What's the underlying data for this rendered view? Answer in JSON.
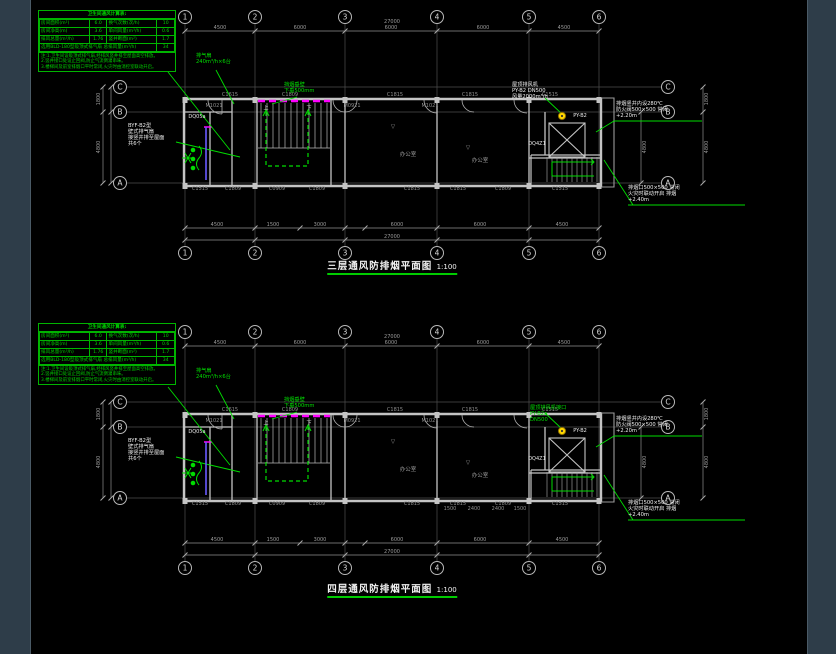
{
  "colors": {
    "canvas": "#000000",
    "margin": "#2e3d49",
    "green": "#00dd00",
    "magenta": "#ff00ff",
    "yellow": "#ffd700",
    "wall": "#c4c4c4",
    "dim_text": "#9a9a9a"
  },
  "legend": {
    "title": "卫生间通风计算表:",
    "rows": [
      [
        "房间面积(m²)",
        "6.0",
        "换气次数(次/h)",
        "10"
      ],
      [
        "房间净高(m)",
        "3.6",
        "单间风量(m³/h)",
        "0.6"
      ],
      [
        "排风总量(m³/h)",
        "1.76",
        "竖井断面(m²)",
        "1.7"
      ]
    ],
    "merged_label": "选用BLD-180型吸顶式排气扇 总排风量(m³/h)",
    "merged_value": "34",
    "notes": [
      "注:1.卫生间设吸顶式排气扇,经排风竖井排至屋面高空排放。",
      "2.竖井接口处设止回阀,防止气流倒灌串味。",
      "3.楼梯间及前室排烟口平时常闭,火灾时由消控室联动开启。"
    ]
  },
  "plans": [
    {
      "title": "三层通风防排烟平面图",
      "scale": "1:100",
      "title_y": 258,
      "offset_y": 0,
      "grid": {
        "cols": [
          "1",
          "2",
          "3",
          "4",
          "5",
          "6"
        ],
        "rows": [
          "C",
          "B",
          "A"
        ]
      },
      "dims": {
        "top_overall": "27000",
        "top_segments": [
          {
            "t": "4500",
            "x": 220
          },
          {
            "t": "6000",
            "x": 300
          },
          {
            "t": "6000",
            "x": 391
          },
          {
            "t": "6000",
            "x": 483
          },
          {
            "t": "4500",
            "x": 564
          }
        ],
        "bottom_segments": [
          {
            "t": "4500",
            "x": 217
          },
          {
            "t": "1500",
            "x": 273
          },
          {
            "t": "3000",
            "x": 320
          },
          {
            "t": "6000",
            "x": 397
          },
          {
            "t": "6000",
            "x": 480
          },
          {
            "t": "4500",
            "x": 562
          }
        ],
        "bottom_overall": "27000",
        "left": [
          {
            "t": "1800",
            "y": 99
          },
          {
            "t": "4800",
            "y": 147
          }
        ],
        "right": [
          {
            "t": "1800",
            "y": 99
          },
          {
            "t": "4800",
            "y": 147
          }
        ],
        "right_inner": [
          {
            "t": "4800",
            "y": 147
          }
        ]
      },
      "tags": [
        {
          "t": "C1615",
          "x": 230,
          "y": 95,
          "c": "g"
        },
        {
          "t": "C1809",
          "x": 290,
          "y": 95,
          "c": "g"
        },
        {
          "t": "C1815",
          "x": 395,
          "y": 95,
          "c": "g"
        },
        {
          "t": "C1815",
          "x": 470,
          "y": 95,
          "c": "g"
        },
        {
          "t": "C1515",
          "x": 550,
          "y": 95,
          "c": "g"
        },
        {
          "t": "M1021",
          "x": 214,
          "y": 106,
          "c": "g"
        },
        {
          "t": "M0921",
          "x": 352,
          "y": 106,
          "c": "g"
        },
        {
          "t": "M1021",
          "x": 430,
          "y": 106,
          "c": "g"
        },
        {
          "t": "C1515",
          "x": 200,
          "y": 189,
          "c": "g"
        },
        {
          "t": "C1809",
          "x": 233,
          "y": 189,
          "c": "g"
        },
        {
          "t": "C0909",
          "x": 277,
          "y": 189,
          "c": "g"
        },
        {
          "t": "C1809",
          "x": 317,
          "y": 189,
          "c": "g"
        },
        {
          "t": "C1815",
          "x": 412,
          "y": 189,
          "c": "g"
        },
        {
          "t": "C1815",
          "x": 458,
          "y": 189,
          "c": "g"
        },
        {
          "t": "C1809",
          "x": 503,
          "y": 189,
          "c": "g"
        },
        {
          "t": "C1515",
          "x": 560,
          "y": 189,
          "c": "g"
        },
        {
          "t": "DQ05a",
          "x": 197,
          "y": 117,
          "c": "w"
        },
        {
          "t": "DQ4Z1",
          "x": 537,
          "y": 144,
          "c": "w"
        },
        {
          "t": "PY-B2",
          "x": 580,
          "y": 116,
          "c": "w"
        },
        {
          "t": "上",
          "x": 266,
          "y": 108,
          "c": "w"
        },
        {
          "t": "下",
          "x": 309,
          "y": 108,
          "c": "w"
        },
        {
          "t": "▽",
          "x": 393,
          "y": 127,
          "c": "r"
        },
        {
          "t": "▽",
          "x": 468,
          "y": 148,
          "c": "r"
        },
        {
          "t": "办公室",
          "x": 408,
          "y": 154,
          "c": "r"
        },
        {
          "t": "办公室",
          "x": 480,
          "y": 160,
          "c": "r"
        }
      ],
      "annotations": [
        {
          "c": "g",
          "x": 196,
          "y": 53,
          "lines": [
            "排气扇",
            "240m³/h×6台"
          ]
        },
        {
          "c": "g",
          "x": 284,
          "y": 82,
          "lines": [
            "挡烟垂壁",
            "下垂500mm"
          ]
        },
        {
          "c": "w",
          "x": 128,
          "y": 123,
          "lines": [
            "BYF-B2型",
            "壁式排气扇",
            "接竖井排至屋面",
            "共6个"
          ]
        },
        {
          "c": "w",
          "x": 512,
          "y": 82,
          "lines": [
            "屋顶排风机",
            "PY-B2 DN500",
            "风量2000m³/h"
          ]
        },
        {
          "c": "w",
          "x": 616,
          "y": 101,
          "lines": [
            "排烟竖井内设280℃",
            "防火阀500×500 常闭",
            "+2.20m"
          ]
        },
        {
          "c": "w",
          "x": 628,
          "y": 185,
          "lines": [
            "排烟口500×500 常闭",
            "火灾时联动开启 排烟",
            "+2.40m"
          ]
        }
      ]
    },
    {
      "title": "四层通风防排烟平面图",
      "scale": "1:100",
      "title_y": 581,
      "offset_y": 315,
      "grid": {
        "cols": [
          "1",
          "2",
          "3",
          "4",
          "5",
          "6"
        ],
        "rows": [
          "C",
          "B",
          "A"
        ]
      },
      "dims": {
        "top_overall": "27000",
        "top_segments": [
          {
            "t": "4500",
            "x": 220
          },
          {
            "t": "6000",
            "x": 300
          },
          {
            "t": "6000",
            "x": 391
          },
          {
            "t": "6000",
            "x": 483
          },
          {
            "t": "4500",
            "x": 564
          }
        ],
        "bottom_segments": [
          {
            "t": "4500",
            "x": 217
          },
          {
            "t": "1500",
            "x": 273
          },
          {
            "t": "3000",
            "x": 320
          },
          {
            "t": "6000",
            "x": 397
          },
          {
            "t": "6000",
            "x": 480
          },
          {
            "t": "4500",
            "x": 562
          }
        ],
        "bottom_overall": "27000",
        "left": [
          {
            "t": "1800",
            "y": 99
          },
          {
            "t": "4800",
            "y": 147
          }
        ],
        "right": [
          {
            "t": "1800",
            "y": 99
          },
          {
            "t": "4800",
            "y": 147
          }
        ],
        "right_inner": [
          {
            "t": "4800",
            "y": 147
          }
        ]
      },
      "tags": [
        {
          "t": "C1615",
          "x": 230,
          "y": 95,
          "c": "g"
        },
        {
          "t": "C1809",
          "x": 290,
          "y": 95,
          "c": "g"
        },
        {
          "t": "C1815",
          "x": 395,
          "y": 95,
          "c": "g"
        },
        {
          "t": "C1815",
          "x": 470,
          "y": 95,
          "c": "g"
        },
        {
          "t": "C1515",
          "x": 550,
          "y": 95,
          "c": "g"
        },
        {
          "t": "M1021",
          "x": 214,
          "y": 106,
          "c": "g"
        },
        {
          "t": "M0921",
          "x": 352,
          "y": 106,
          "c": "g"
        },
        {
          "t": "M1021",
          "x": 430,
          "y": 106,
          "c": "g"
        },
        {
          "t": "C1515",
          "x": 200,
          "y": 189,
          "c": "g"
        },
        {
          "t": "C1809",
          "x": 233,
          "y": 189,
          "c": "g"
        },
        {
          "t": "C0909",
          "x": 277,
          "y": 189,
          "c": "g"
        },
        {
          "t": "C1809",
          "x": 317,
          "y": 189,
          "c": "g"
        },
        {
          "t": "C1815",
          "x": 412,
          "y": 189,
          "c": "g"
        },
        {
          "t": "C1815",
          "x": 458,
          "y": 189,
          "c": "g"
        },
        {
          "t": "C1809",
          "x": 503,
          "y": 189,
          "c": "g"
        },
        {
          "t": "C1515",
          "x": 560,
          "y": 189,
          "c": "g"
        },
        {
          "t": "DQ05a",
          "x": 197,
          "y": 117,
          "c": "w"
        },
        {
          "t": "DQ4Z1",
          "x": 537,
          "y": 144,
          "c": "w"
        },
        {
          "t": "PY-B2",
          "x": 580,
          "y": 116,
          "c": "w"
        },
        {
          "t": "上",
          "x": 266,
          "y": 108,
          "c": "w"
        },
        {
          "t": "下",
          "x": 309,
          "y": 108,
          "c": "w"
        },
        {
          "t": "▽",
          "x": 393,
          "y": 127,
          "c": "r"
        },
        {
          "t": "▽",
          "x": 468,
          "y": 148,
          "c": "r"
        },
        {
          "t": "办公室",
          "x": 408,
          "y": 154,
          "c": "r"
        },
        {
          "t": "办公室",
          "x": 480,
          "y": 160,
          "c": "r"
        },
        {
          "t": "1500",
          "x": 450,
          "y": 194,
          "c": "g"
        },
        {
          "t": "2400",
          "x": 474,
          "y": 194,
          "c": "g"
        },
        {
          "t": "2400",
          "x": 498,
          "y": 194,
          "c": "g"
        },
        {
          "t": "1500",
          "x": 520,
          "y": 194,
          "c": "g"
        }
      ],
      "annotations": [
        {
          "c": "g",
          "x": 196,
          "y": 53,
          "lines": [
            "排气扇",
            "240m³/h×6台"
          ]
        },
        {
          "c": "g",
          "x": 284,
          "y": 82,
          "lines": [
            "挡烟垂壁",
            "下垂500mm"
          ]
        },
        {
          "c": "w",
          "x": 128,
          "y": 123,
          "lines": [
            "BYF-B2型",
            "壁式排气扇",
            "接竖井排至屋面",
            "共6个"
          ]
        },
        {
          "c": "g",
          "x": 530,
          "y": 405,
          "lines_abs": true,
          "lines": [
            "屋顶排风机接口",
            "PY-B2a",
            "DN500"
          ]
        },
        {
          "c": "w",
          "x": 616,
          "y": 101,
          "lines": [
            "排烟竖井内设280℃",
            "防火阀500×500 常闭",
            "+2.20m"
          ]
        },
        {
          "c": "w",
          "x": 628,
          "y": 185,
          "lines": [
            "排烟口500×500 常闭",
            "火灾时联动开启 排烟",
            "+2.40m"
          ]
        }
      ]
    }
  ]
}
